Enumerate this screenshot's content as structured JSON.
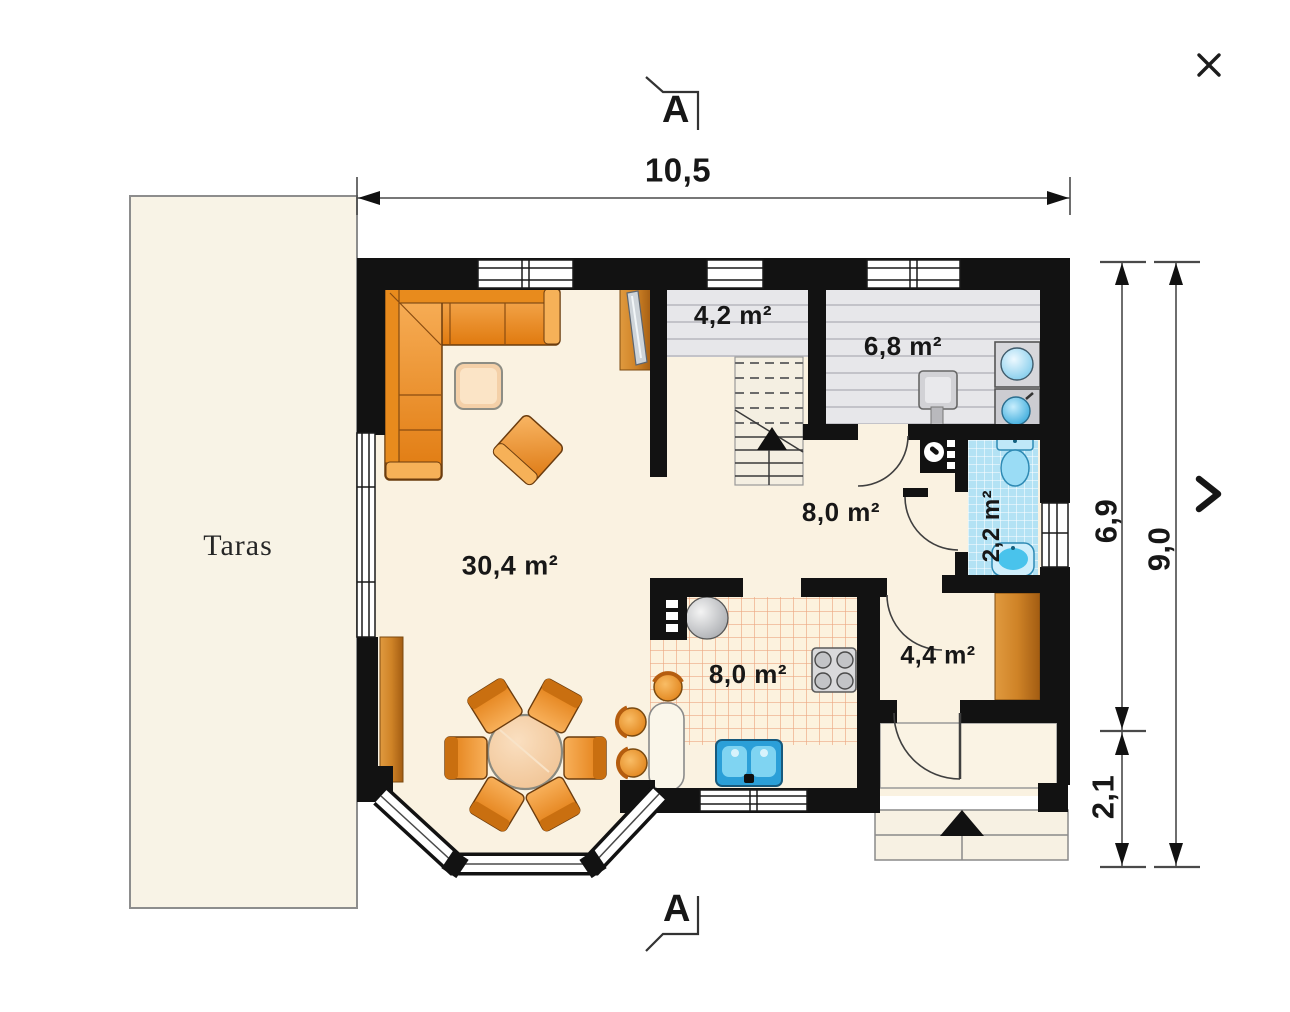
{
  "viewer": {
    "icons": {
      "close": "×",
      "next": "❯"
    }
  },
  "terrace": {
    "label": "Taras"
  },
  "section_markers": {
    "top": "A",
    "bottom": "A"
  },
  "dimensions": {
    "top_width": "10,5",
    "right_upper": "6,9",
    "right_total": "9,0",
    "right_lower": "2,1"
  },
  "rooms": {
    "living": {
      "label": "30,4 m²"
    },
    "landing": {
      "label": "4,2 m²"
    },
    "utility": {
      "label": "6,8 m²"
    },
    "hall": {
      "label": "8,0 m²"
    },
    "wc": {
      "label": "2,2 m²"
    },
    "kitchen": {
      "label": "8,0 m²"
    },
    "wardrobe": {
      "label": "4,4 m²"
    }
  },
  "colors": {
    "wall": "#121212",
    "floor_cream": "#faf2e1",
    "terrace_cream": "#f8f3e6",
    "gray_room": "#e7e7ea",
    "wc_tile_blue": "#b3e2f4",
    "kitchen_grid_red": "#dd6b38",
    "furniture_orange": "#ee8a1f",
    "wood_brown": "#c67f2a",
    "fixture_blue": "#4ec1ea"
  }
}
